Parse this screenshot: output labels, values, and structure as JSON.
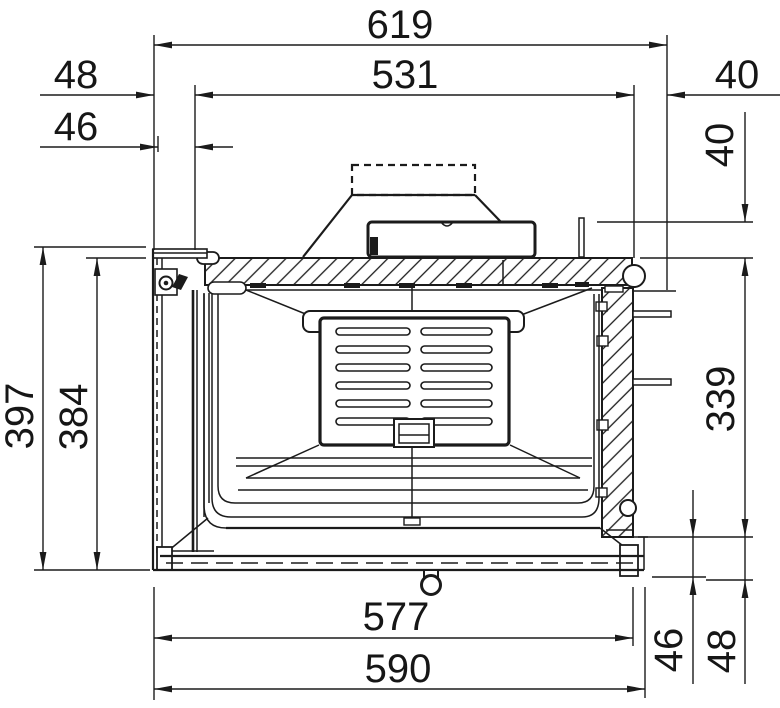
{
  "drawing": {
    "kind": "technical-cross-section",
    "subject": "fireplace-insert-side-section",
    "ink_color": "#1b1b1b",
    "paper_color": "#ffffff"
  },
  "dims": {
    "top_overall": "619",
    "top_inner": "531",
    "front_offset_outer": "48",
    "front_offset_glass": "46",
    "rear_overhang": "40",
    "collar_rise": "40",
    "rear_wall_height": "339",
    "front_height_overall": "397",
    "front_height_body": "384",
    "base_depth_inner": "577",
    "base_depth_overall": "590",
    "base_rise_inner": "46",
    "base_rise_outer": "48"
  }
}
